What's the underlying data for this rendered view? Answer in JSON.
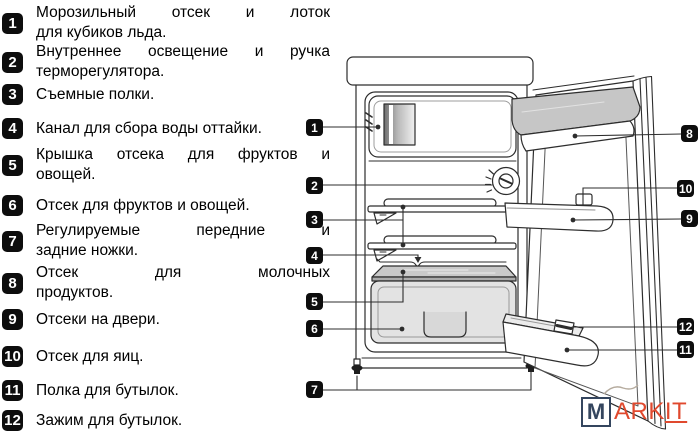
{
  "legend": {
    "items": [
      {
        "num": "1",
        "lines": [
          "Морозильный отсек и лоток",
          "для кубиков льда."
        ]
      },
      {
        "num": "2",
        "lines": [
          "Внутреннее освещение и ручка",
          "терморегулятора."
        ]
      },
      {
        "num": "3",
        "lines": [
          "Съемные полки."
        ]
      },
      {
        "num": "4",
        "lines": [
          "Канал для сбора воды оттайки."
        ]
      },
      {
        "num": "5",
        "lines": [
          "Крышка отсека для фруктов и",
          "овощей."
        ]
      },
      {
        "num": "6",
        "lines": [
          "Отсек для фруктов и овощей."
        ]
      },
      {
        "num": "7",
        "lines": [
          "Регулируемые передние и",
          "задние ножки."
        ]
      },
      {
        "num": "8",
        "lines": [
          "Отсек для молочных",
          "продуктов."
        ]
      },
      {
        "num": "9",
        "lines": [
          "Отсеки на двери."
        ]
      },
      {
        "num": "10",
        "lines": [
          "Отсек для яиц."
        ]
      },
      {
        "num": "11",
        "lines": [
          "Полка для бутылок."
        ]
      },
      {
        "num": "12",
        "lines": [
          "Зажим для бутылок."
        ]
      }
    ]
  },
  "diagram": {
    "callouts": [
      "1",
      "2",
      "3",
      "4",
      "5",
      "6",
      "7",
      "8",
      "9",
      "10",
      "11",
      "12"
    ]
  },
  "watermark": {
    "boxed": "M",
    "plain": "ARK",
    "underlined": "IT"
  },
  "colors": {
    "badge_bg": "#0d0d0d",
    "drawing_outline": "#2d2d2d",
    "shade_light": "#e3e3e3",
    "shade_mid": "#c6c6c6",
    "watermark_box": "#34455e",
    "watermark_text": "#e0492e"
  }
}
